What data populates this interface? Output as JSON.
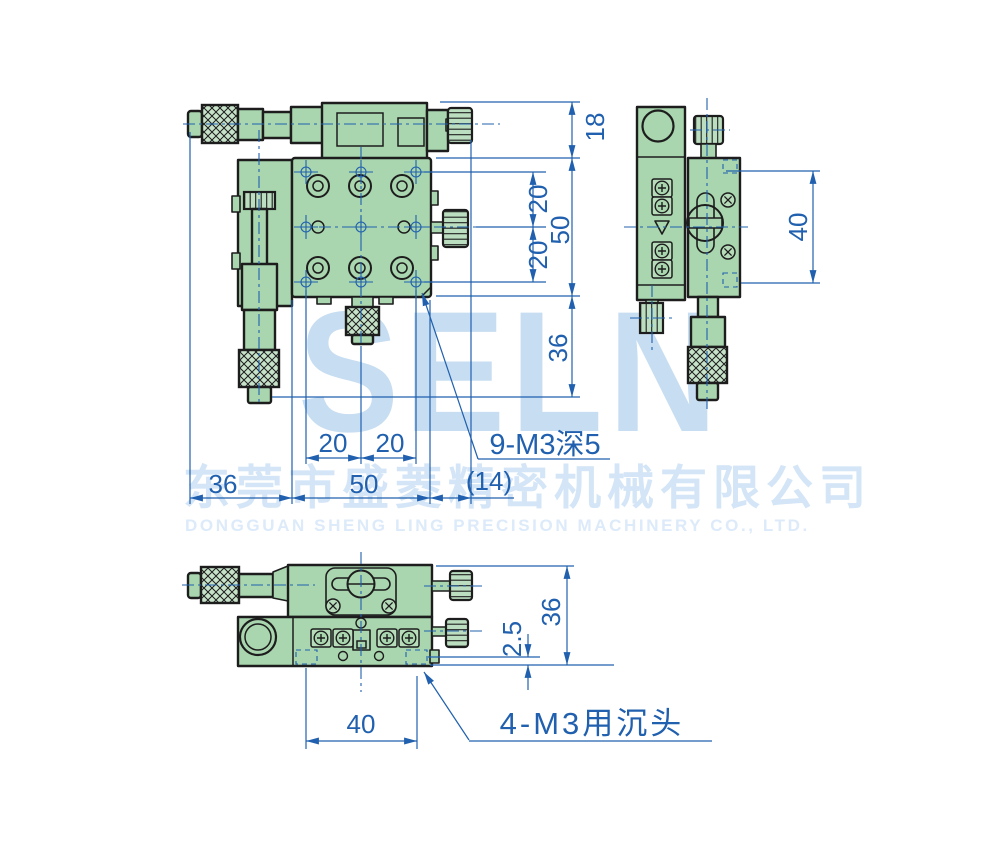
{
  "watermark": {
    "logo": "SELN",
    "company_cn": "东莞市盛菱精密机械有限公司",
    "company_en": "DONGGUAN SHENG LING PRECISION MACHINERY CO., LTD."
  },
  "colors": {
    "dimension_blue": "#2060ae",
    "body_green": "#a9d6ae",
    "outline_dark": "#1d1d1d",
    "watermark_light_blue": "#c7ddf1"
  },
  "views": {
    "plan": {
      "dims": {
        "carriage_height": "18",
        "hole_pitch_right_top": "20",
        "hole_pitch_right_bottom": "20",
        "plate_size_right": "50",
        "micrometer_clearance": "36",
        "hole_pitch_bottom_left": "20",
        "hole_pitch_bottom_right": "20",
        "body_width_left": "36",
        "plate_size_bottom": "50",
        "knob_overhang": "(14)"
      },
      "callout_holes": "9-M3深5"
    },
    "side": {
      "dims": {
        "mount_pitch": "40"
      }
    },
    "front": {
      "dims": {
        "overall_height": "36",
        "counterbore_offset": "2.5",
        "mount_hole_span": "40"
      },
      "callout_holes": "4-M3用沉头"
    }
  }
}
